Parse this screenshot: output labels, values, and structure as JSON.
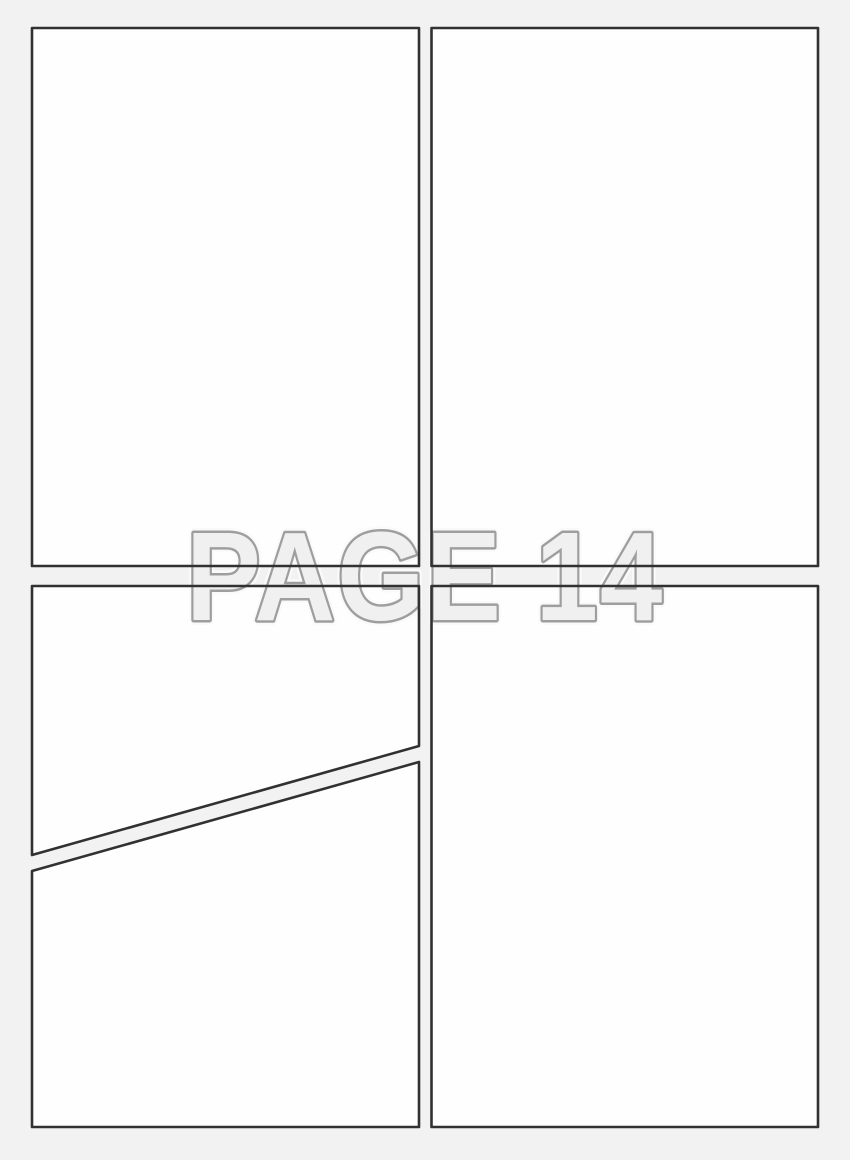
{
  "page": {
    "label": "PAGE 14",
    "page_number": "14"
  },
  "template": {
    "panel_count": 5,
    "panels": [
      {
        "id": "panel-1",
        "position": "top-left",
        "shape": "rectangle"
      },
      {
        "id": "panel-2",
        "position": "top-right",
        "shape": "rectangle"
      },
      {
        "id": "panel-3",
        "position": "middle-left-above-diagonal",
        "shape": "diagonal-cut-quad"
      },
      {
        "id": "panel-4",
        "position": "bottom-left-below-diagonal",
        "shape": "diagonal-cut-quad"
      },
      {
        "id": "panel-5",
        "position": "bottom-right",
        "shape": "rectangle"
      }
    ]
  },
  "colors": {
    "background": "#f2f2f3",
    "panel_fill": "#fefefe",
    "panel_border": "#313131",
    "label_fill": "#f0f0f0",
    "label_outline": "#9e9e9e",
    "label_halo": "#fafafa"
  }
}
